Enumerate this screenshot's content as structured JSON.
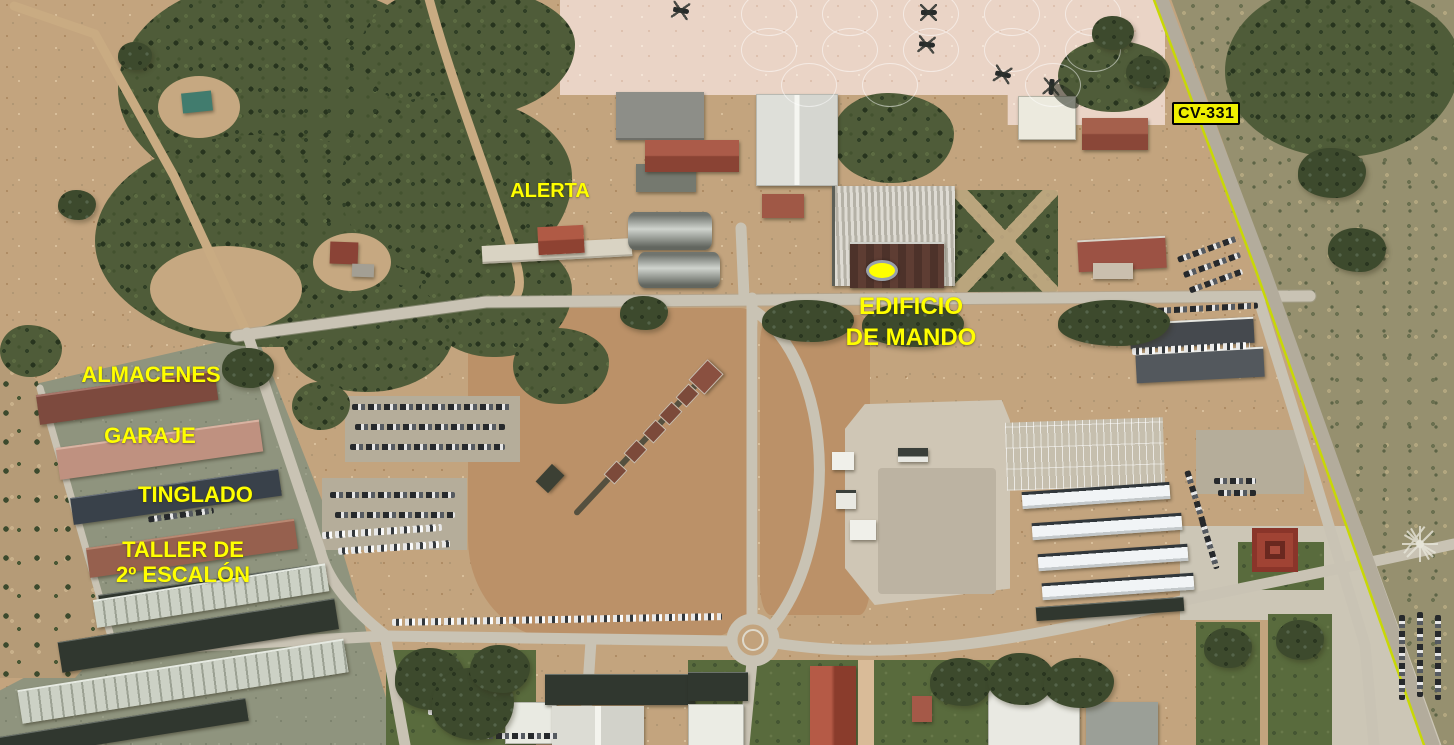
{
  "annotations": {
    "alerta": {
      "text": "ALERTA"
    },
    "edificio_de_mando": {
      "line1": "EDIFICIO",
      "line2": "DE MANDO"
    },
    "almacenes": {
      "text": "ALMACENES"
    },
    "garaje": {
      "text": "GARAJE"
    },
    "tinglado": {
      "text": "TINGLADO"
    },
    "taller_2_escalon": {
      "line1": "TALLER DE",
      "line2": "2º ESCALÓN"
    },
    "road_badge": {
      "text": "CV-331"
    }
  },
  "colors": {
    "annotation_text": "#ffff00",
    "badge_background": "#f0f000",
    "badge_text": "#0a0a00",
    "badge_border": "#000000",
    "marker_fill": "#ffff00",
    "marker_ring": "#99a1ab"
  }
}
